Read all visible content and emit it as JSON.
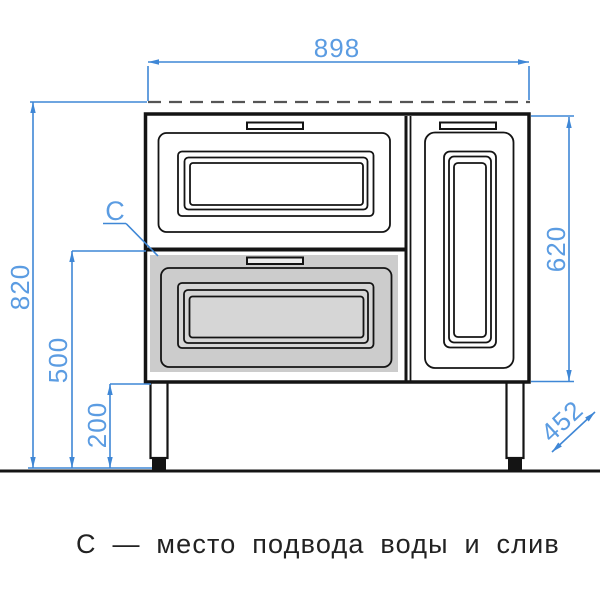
{
  "dimensions": {
    "width": "898",
    "overall_height": "820",
    "cabinet_height": "620",
    "water_supply_height": "500",
    "leg_clearance": "200",
    "depth": "452"
  },
  "annotation": {
    "marker": "С",
    "caption": "С — место подвода воды и слив"
  },
  "colors": {
    "dimension_blue": "#3f87d6",
    "dimension_text_blue": "#5b9ce2",
    "outline_black": "#141414",
    "dashed_gray": "#555555",
    "drawer_highlight_gray": "#cccccc",
    "drawer_highlight_inner_gray": "#d6d6d6",
    "handle_light": "#ececec",
    "background": "#ffffff"
  }
}
